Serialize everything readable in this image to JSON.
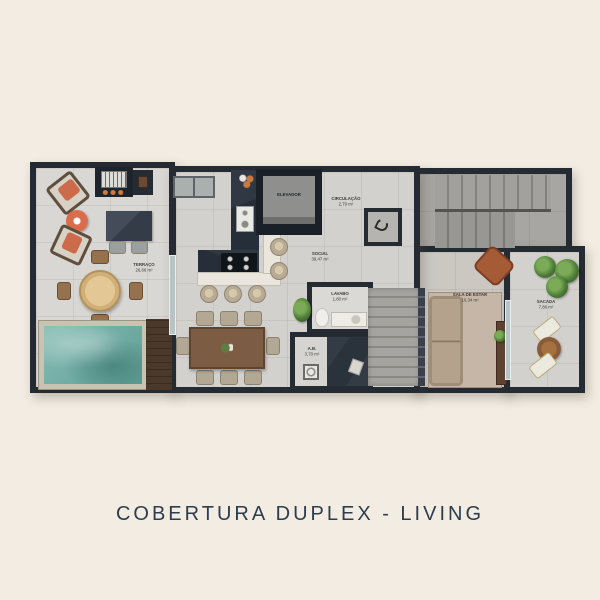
{
  "title": {
    "text": "COBERTURA DUPLEX - LIVING"
  },
  "colors": {
    "background": "#f2ece3",
    "wall": "#242b33",
    "pool_water": "#6fa8a0",
    "accent_orange": "#d96d4b",
    "wood": "#7c5c42",
    "title_text": "#2c3d4e"
  },
  "rooms": {
    "terraco": {
      "label": "TERRAÇO",
      "area": "26,66 m²"
    },
    "social": {
      "label": "SOCIAL",
      "area": "39,47 m²"
    },
    "elevador": {
      "label": "ELEVADOR"
    },
    "circulacao": {
      "label": "CIRCULAÇÃO",
      "area": "2,79 m²"
    },
    "lavabo": {
      "label": "LAVABO",
      "area": "1,80 m²"
    },
    "ab": {
      "label": "A.B.",
      "area": "3,70 m²"
    },
    "sala": {
      "label": "SALA DE ESTAR",
      "area": "10,34 m²"
    },
    "sacada": {
      "label": "SACADA",
      "area": "7,86 m²"
    }
  }
}
